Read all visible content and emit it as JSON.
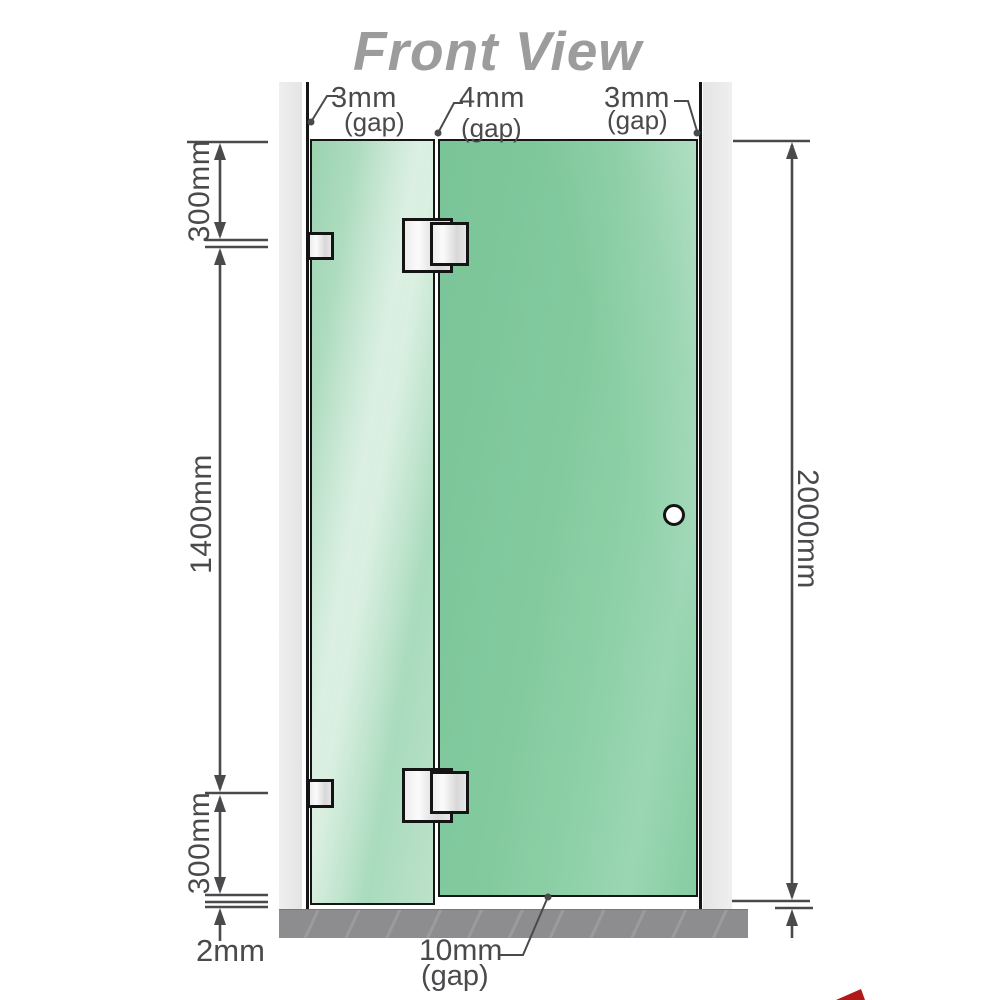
{
  "title": "Front View",
  "colors": {
    "dimension_gray": "#4a4a4d",
    "title_gray": "#9c9c9c",
    "wall_gray": "#e9e9e9",
    "floor_gray": "#8d8d8f",
    "glass_green": "#84cba0",
    "glass_green_light": "#cdead6",
    "hinge_silver": "#ececec",
    "accent_red": "#b01919"
  },
  "view": {
    "gaps_top": [
      {
        "value": "3mm",
        "suffix": "(gap)",
        "position": "left-wall-to-panel"
      },
      {
        "value": "4mm",
        "suffix": "(gap)",
        "position": "panel-to-door"
      },
      {
        "value": "3mm",
        "suffix": "(gap)",
        "position": "door-to-right-wall"
      }
    ],
    "dims_left": [
      {
        "value": "300mm",
        "position": "top"
      },
      {
        "value": "1400mm",
        "position": "middle"
      },
      {
        "value": "300mm",
        "position": "bottom"
      }
    ],
    "dim_floor_clearance": "2mm",
    "dim_right_height": "2000mm",
    "gap_bottom": {
      "value": "10mm",
      "suffix": "(gap)"
    }
  }
}
